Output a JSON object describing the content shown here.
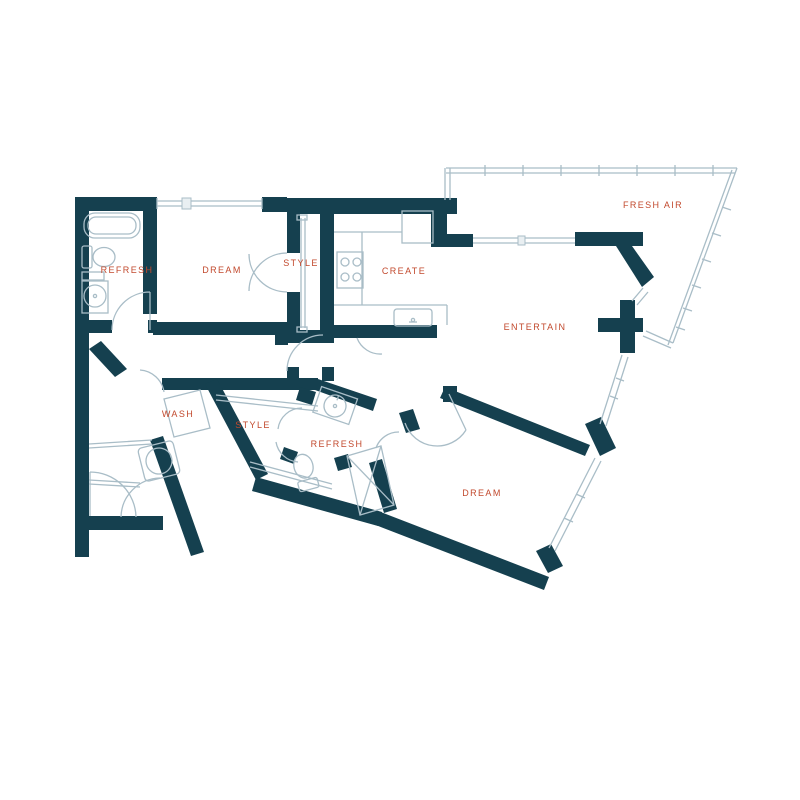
{
  "plan": {
    "title": "apartment-floor-plan",
    "rooms": [
      {
        "id": "refresh-upper",
        "label": "REFRESH"
      },
      {
        "id": "dream-upper",
        "label": "DREAM"
      },
      {
        "id": "style-upper",
        "label": "STYLE"
      },
      {
        "id": "create",
        "label": "CREATE"
      },
      {
        "id": "entertain",
        "label": "ENTERTAIN"
      },
      {
        "id": "fresh-air",
        "label": "FRESH AIR"
      },
      {
        "id": "wash",
        "label": "WASH"
      },
      {
        "id": "style-lower",
        "label": "STYLE"
      },
      {
        "id": "refresh-lower",
        "label": "REFRESH"
      },
      {
        "id": "dream-lower",
        "label": "DREAM"
      }
    ],
    "fixtures": [
      "bathtub-icon",
      "toilet-icon",
      "pedestal-sink-icon",
      "wardrobe-shelves-icon",
      "range-stove-icon",
      "refrigerator-icon",
      "kitchen-sink-icon",
      "sliding-door-icon",
      "balcony-railing-icon",
      "washer-dryer-icon",
      "water-heater-icon",
      "vanity-sink-icon",
      "shower-icon",
      "door-swing-icon",
      "window-icon"
    ],
    "colors": {
      "wall": "#15404f",
      "label": "#c2492d",
      "line": "#a9bdc7",
      "light": "#e9eff2",
      "background": "#ffffff"
    }
  }
}
